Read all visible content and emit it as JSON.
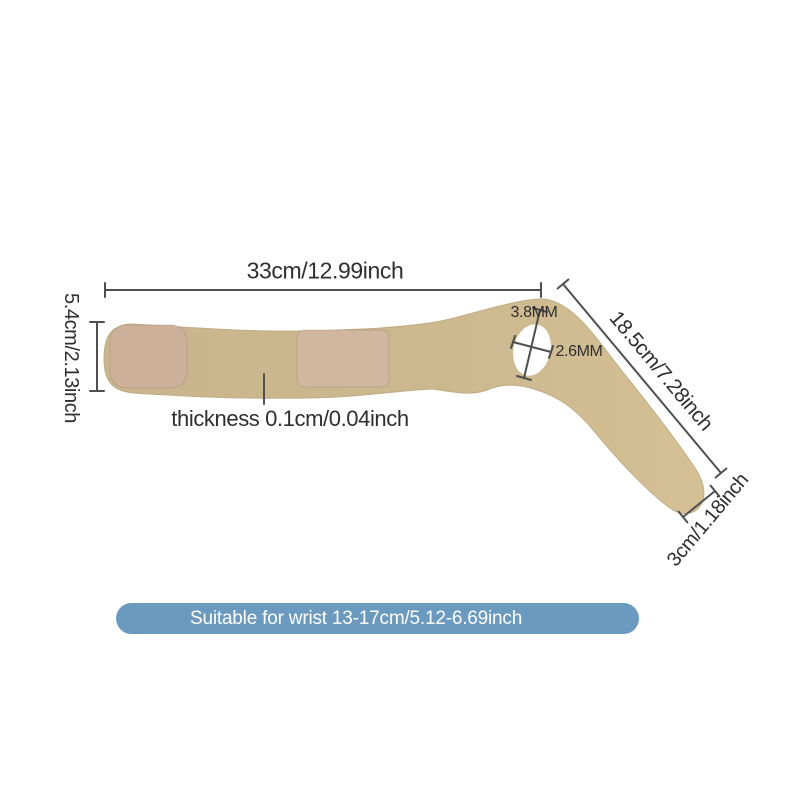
{
  "diagram": {
    "title": "wrist brace size diagram",
    "annotations": {
      "total_length": "33cm/12.99inch",
      "band_width": "5.4cm/2.13inch",
      "thickness": "thickness 0.1cm/0.04inch",
      "hole_major": "3.8MM",
      "hole_minor": "2.6MM",
      "tail_length": "18.5cm/7.28inch",
      "tail_end_width": "3cm/1.18inch"
    },
    "colors": {
      "background": "#ffffff",
      "strap_left": "#c9b68e",
      "strap_right": "#d5c094",
      "patch": "#cdb19b",
      "patch2": "#d2b7a0",
      "hole": "#ffffff",
      "dimension_line": "#4f4f4f",
      "text": "#2f2f2f",
      "banner_bg": "#6b9ac1",
      "banner_text": "#ffffff"
    }
  },
  "banner": {
    "label": "Suitable for wrist 13-17cm/5.12-6.69inch"
  }
}
